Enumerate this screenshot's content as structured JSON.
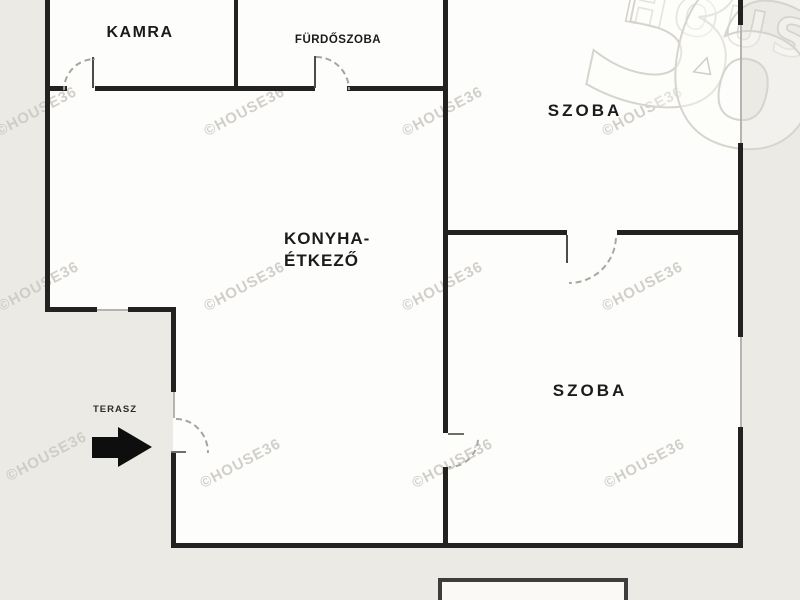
{
  "plan": {
    "rooms": [
      {
        "id": "kamra",
        "label": "KAMRA"
      },
      {
        "id": "furdoszoba",
        "label": "FÜRDŐSZOBA"
      },
      {
        "id": "szoba-top",
        "label": "SZOBA"
      },
      {
        "id": "konyha-etkezo",
        "label_line1": "KONYHA-",
        "label_line2": "ÉTKEZŐ"
      },
      {
        "id": "szoba-bottom",
        "label": "SZOBA"
      },
      {
        "id": "terasz",
        "label": "TERASZ"
      }
    ]
  },
  "watermark": {
    "small_text": "©HOUSE36",
    "brand_word": "HOUSE",
    "digit_three": "3",
    "digit_six": "6"
  },
  "colors": {
    "background": "#ECEAE5",
    "floor": "#FDFDFB",
    "wall": "#232220",
    "watermark_light": "#CBC8C2",
    "arrow": "#0E0E0E"
  }
}
